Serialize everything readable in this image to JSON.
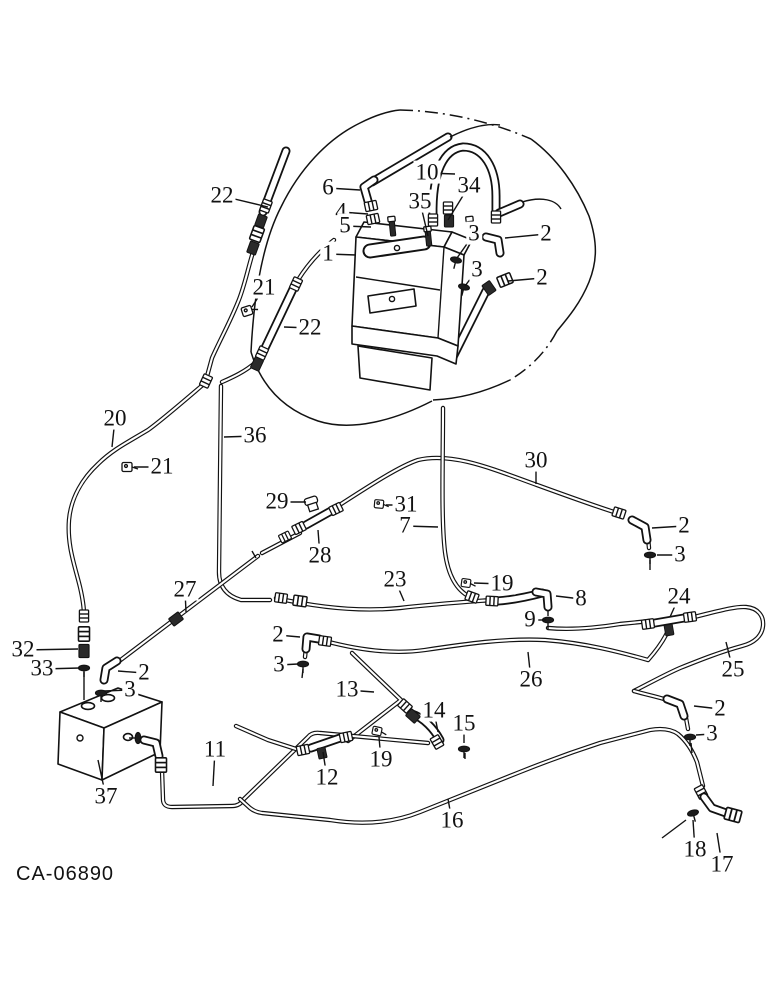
{
  "figure": {
    "type": "hydraulic-lines-parts-diagram",
    "caption": "CA-06890",
    "ink": "#121212",
    "labels": [
      {
        "t": "22",
        "x": 222,
        "y": 196,
        "tx": 268,
        "ty": 207
      },
      {
        "t": "6",
        "x": 328,
        "y": 188,
        "tx": 360,
        "ty": 190
      },
      {
        "t": "10",
        "x": 427,
        "y": 173,
        "tx": 455,
        "ty": 174
      },
      {
        "t": "34",
        "x": 469,
        "y": 186,
        "tx": 448,
        "ty": 220
      },
      {
        "t": "35",
        "x": 420,
        "y": 202,
        "tx": 428,
        "ty": 236
      },
      {
        "t": "4",
        "x": 341,
        "y": 212,
        "tx": 368,
        "ty": 214
      },
      {
        "t": "5",
        "x": 345,
        "y": 226,
        "tx": 371,
        "ty": 227
      },
      {
        "t": "1",
        "x": 328,
        "y": 254,
        "tx": 356,
        "ty": 255
      },
      {
        "t": "3",
        "x": 474,
        "y": 234,
        "tx": 457,
        "ty": 258
      },
      {
        "t": "2",
        "x": 546,
        "y": 234,
        "tx": 505,
        "ty": 238
      },
      {
        "t": "3",
        "x": 477,
        "y": 270,
        "tx": 465,
        "ty": 286
      },
      {
        "t": "2",
        "x": 542,
        "y": 278,
        "tx": 508,
        "ty": 281
      },
      {
        "t": "21",
        "x": 264,
        "y": 288,
        "tx": 252,
        "ty": 307
      },
      {
        "t": "22",
        "x": 310,
        "y": 328,
        "tx": 284,
        "ty": 327
      },
      {
        "t": "20",
        "x": 115,
        "y": 419,
        "tx": 112,
        "ty": 447
      },
      {
        "t": "36",
        "x": 255,
        "y": 436,
        "tx": 224,
        "ty": 437
      },
      {
        "t": "21",
        "x": 162,
        "y": 467,
        "tx": 134,
        "ty": 467
      },
      {
        "t": "30",
        "x": 536,
        "y": 461,
        "tx": 536,
        "ty": 484
      },
      {
        "t": "29",
        "x": 277,
        "y": 502,
        "tx": 306,
        "ty": 502
      },
      {
        "t": "31",
        "x": 406,
        "y": 505,
        "tx": 386,
        "ty": 505
      },
      {
        "t": "7",
        "x": 405,
        "y": 526,
        "tx": 438,
        "ty": 527
      },
      {
        "t": "28",
        "x": 320,
        "y": 556,
        "tx": 318,
        "ty": 530
      },
      {
        "t": "2",
        "x": 684,
        "y": 526,
        "tx": 652,
        "ty": 528
      },
      {
        "t": "3",
        "x": 680,
        "y": 555,
        "tx": 657,
        "ty": 555
      },
      {
        "t": "27",
        "x": 185,
        "y": 590,
        "tx": 186,
        "ty": 612
      },
      {
        "t": "23",
        "x": 395,
        "y": 580,
        "tx": 404,
        "ty": 601
      },
      {
        "t": "19",
        "x": 502,
        "y": 584,
        "tx": 474,
        "ty": 583
      },
      {
        "t": "8",
        "x": 581,
        "y": 599,
        "tx": 556,
        "ty": 596
      },
      {
        "t": "9",
        "x": 530,
        "y": 620,
        "tx": 546,
        "ty": 620
      },
      {
        "t": "24",
        "x": 679,
        "y": 597,
        "tx": 670,
        "ty": 617
      },
      {
        "t": "32",
        "x": 23,
        "y": 650,
        "tx": 78,
        "ty": 649
      },
      {
        "t": "33",
        "x": 42,
        "y": 669,
        "tx": 80,
        "ty": 668
      },
      {
        "t": "2",
        "x": 144,
        "y": 673,
        "tx": 118,
        "ty": 671
      },
      {
        "t": "3",
        "x": 130,
        "y": 690,
        "tx": 104,
        "ty": 691
      },
      {
        "t": "26",
        "x": 531,
        "y": 680,
        "tx": 528,
        "ty": 652
      },
      {
        "t": "25",
        "x": 733,
        "y": 670,
        "tx": 726,
        "ty": 642
      },
      {
        "t": "13",
        "x": 347,
        "y": 690,
        "tx": 374,
        "ty": 692
      },
      {
        "t": "2",
        "x": 278,
        "y": 635,
        "tx": 300,
        "ty": 637
      },
      {
        "t": "3",
        "x": 279,
        "y": 665,
        "tx": 298,
        "ty": 664
      },
      {
        "t": "14",
        "x": 434,
        "y": 711,
        "tx": 438,
        "ty": 732
      },
      {
        "t": "15",
        "x": 464,
        "y": 724,
        "tx": 464,
        "ty": 743
      },
      {
        "t": "19",
        "x": 381,
        "y": 760,
        "tx": 379,
        "ty": 737
      },
      {
        "t": "12",
        "x": 327,
        "y": 778,
        "tx": 323,
        "ty": 752
      },
      {
        "t": "11",
        "x": 215,
        "y": 750,
        "tx": 213,
        "ty": 786
      },
      {
        "t": "16",
        "x": 452,
        "y": 821,
        "tx": 448,
        "ty": 799
      },
      {
        "t": "2",
        "x": 720,
        "y": 709,
        "tx": 694,
        "ty": 706
      },
      {
        "t": "3",
        "x": 712,
        "y": 734,
        "tx": 696,
        "ty": 735
      },
      {
        "t": "18",
        "x": 695,
        "y": 850,
        "tx": 693,
        "ty": 820
      },
      {
        "t": "17",
        "x": 722,
        "y": 865,
        "tx": 717,
        "ty": 833
      },
      {
        "t": "37",
        "x": 106,
        "y": 797,
        "tx": 98,
        "ty": 760
      }
    ]
  }
}
